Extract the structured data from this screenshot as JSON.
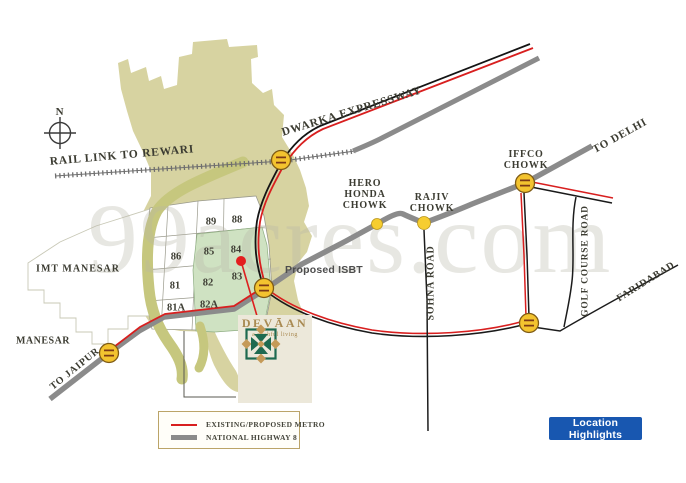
{
  "watermark": "99acres.com",
  "compass_north": "N",
  "labels": {
    "rail_link": "RAIL LINK TO REWARI",
    "dwarka": "DWARKA EXPRESSWAY",
    "to_delhi": "TO DELHI",
    "iffco_line1": "IFFCO",
    "iffco_line2": "CHOWK",
    "hero_line1": "HERO",
    "hero_line2": "HONDA",
    "hero_line3": "CHOWK",
    "rajiv_line1": "RAJIV",
    "rajiv_line2": "CHOWK",
    "sohna": "SOHNA ROAD",
    "golf_course": "GOLF COURSE ROAD",
    "faridabad": "FARIDABAD",
    "imt_manesar": "IMT MANESAR",
    "manesar": "MANESAR",
    "to_jaipur": "TO JAIPUR",
    "proposed_isbt": "Proposed ISBT"
  },
  "sectors": [
    "89",
    "88",
    "86",
    "85",
    "84",
    "81",
    "82",
    "83",
    "81A",
    "82A"
  ],
  "logo": {
    "brand": "DEVĀAN",
    "tagline": "a wishful living"
  },
  "legend": {
    "metro_label": "EXISTING/PROPOSED METRO",
    "highway_label": "NATIONAL HIGHWAY 8"
  },
  "action_button": {
    "label": "Location Highlights"
  },
  "colors": {
    "metro_red": "#d81f1f",
    "highway_gray": "#8b8b8b",
    "railway_gray": "#6f6f6f",
    "junction_yellow": "#f3c32f",
    "landuse_khaki": "#d7d3a1",
    "greenbelt_olive": "#c6c77e",
    "sector_green": "#cfe2c2",
    "brand_gold": "#a98a52",
    "brand_green": "#1e6a50",
    "button_blue": "#1857b0"
  }
}
